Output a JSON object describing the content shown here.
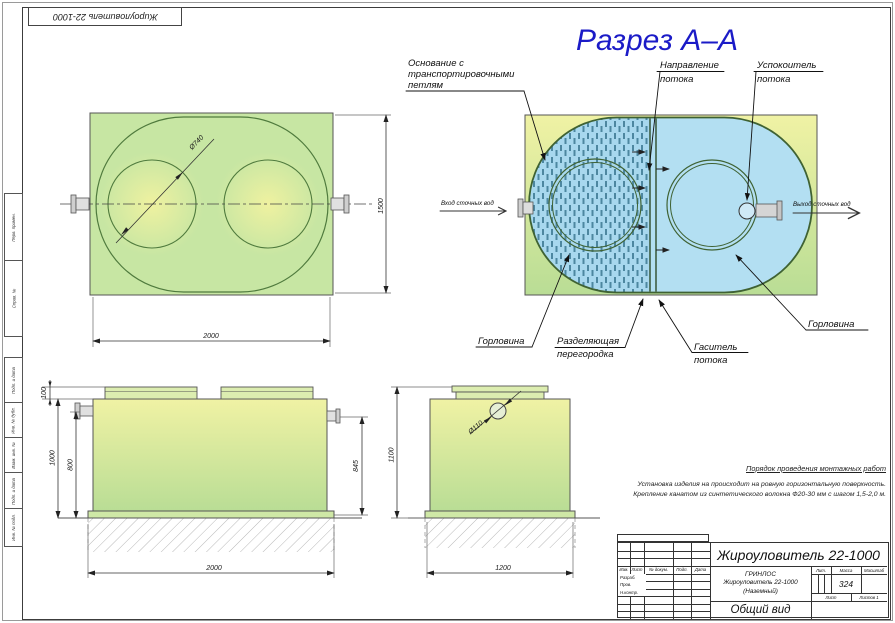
{
  "sheet": {
    "top_stamp": "Жироуловитель 22-1000",
    "margin_labels": [
      "Перв. примен.",
      "Справ. №",
      "Подп. и дата",
      "Инв. № дубл.",
      "Взам. инв. №",
      "Подп. и дата",
      "Инв. № подл."
    ]
  },
  "section": {
    "title": "Разрез А–А",
    "callouts": {
      "base": [
        "Основание с",
        "транспортировочными",
        "петлям"
      ],
      "direction": [
        "Направление",
        "потока"
      ],
      "stiller": [
        "Успокоитель",
        "потока"
      ],
      "inlet": "Вход сточных вод",
      "outlet": "Выход сточных вод",
      "neck_left": "Горловина",
      "neck_right": "Горловина",
      "partition": [
        "Разделяющая",
        "перегородка"
      ],
      "damper": [
        "Гаситель",
        "потока"
      ]
    }
  },
  "dims": {
    "plan_width": "2000",
    "plan_height": "1500",
    "neck_dia": "Ø740",
    "front_lid_h": "100",
    "front_total_h": "1000",
    "front_inlet_h": "800",
    "front_outlet_h": "845",
    "front_width": "2000",
    "side_height": "1100",
    "side_width": "1200",
    "pipe_dia": "Ø110"
  },
  "notes": {
    "header": "Порядок проведения монтажных работ",
    "lines": [
      "Установка изделия на происходит на ровную горизонтальную поверхность.",
      "Крепление канатом из синтетического волокна Ф20-30 мм с шагом 1,5-2,0 м."
    ]
  },
  "title_block": {
    "doc_number": "Жироуловитель 22-1000",
    "org": "ГРИНЛОС",
    "product": "Жироуловитель 22-1000",
    "variant": "(Наземный)",
    "view_title": "Общий вид",
    "mass": "324",
    "labels": {
      "izm": "Изм.",
      "list": "Лист",
      "doc": "№ докум.",
      "podp": "Подп.",
      "data": "Дата",
      "razrab": "Разраб.",
      "prov": "Пров.",
      "nkontr": "Н.контр.",
      "lit": "Лит.",
      "massa": "Масса",
      "masshtab": "Масштаб",
      "sheet": "Лист",
      "sheets": "Листов 1"
    }
  },
  "colors": {
    "accent_blue": "#1b1bc7",
    "tank_green": "#c7e6a3",
    "water_blue": "#b3dff2"
  }
}
